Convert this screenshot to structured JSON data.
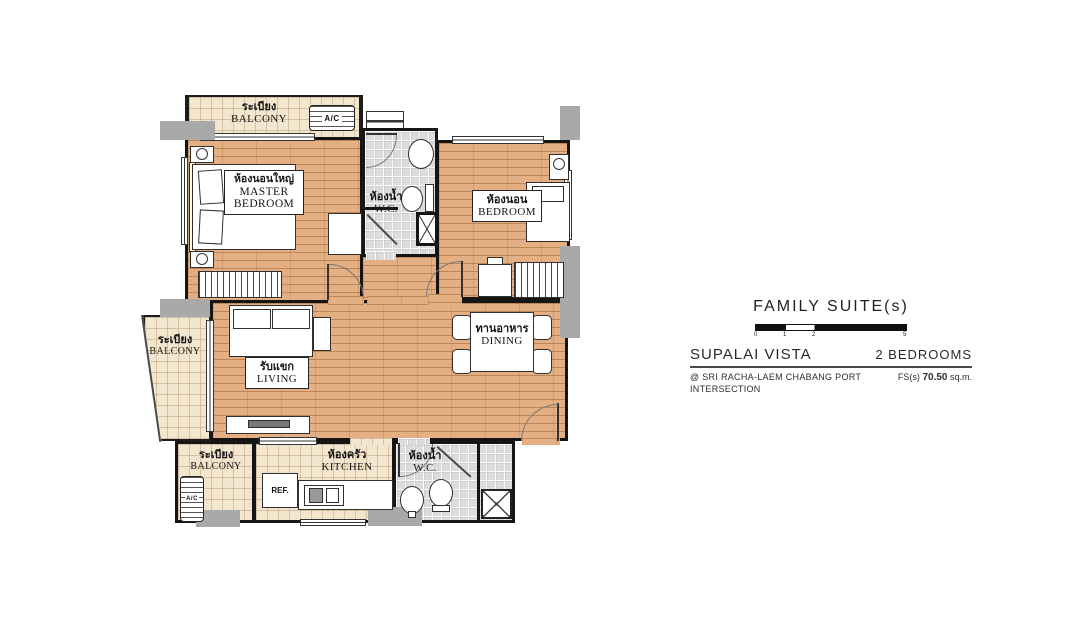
{
  "floorplan": {
    "rooms": {
      "balcony_top": {
        "thai": "ระเบียง",
        "en": "BALCONY"
      },
      "balcony_left": {
        "thai": "ระเบียง",
        "en": "BALCONY"
      },
      "balcony_bottom": {
        "thai": "ระเบียง",
        "en": "BALCONY"
      },
      "master_bedroom": {
        "thai": "ห้องนอนใหญ่",
        "en": "MASTER BEDROOM"
      },
      "bedroom": {
        "thai": "ห้องนอน",
        "en": "BEDROOM"
      },
      "wc_top": {
        "thai": "ห้องน้ำ",
        "en": "W.C."
      },
      "wc_bottom": {
        "thai": "ห้องน้ำ",
        "en": "W.C."
      },
      "living": {
        "thai": "รับแขก",
        "en": "LIVING"
      },
      "dining": {
        "thai": "ทานอาหาร",
        "en": "DINING"
      },
      "kitchen": {
        "thai": "ห้องครัว",
        "en": "KITCHEN"
      }
    },
    "equipment": {
      "ac_top": "A/C",
      "ac_bottom": "A/C",
      "fridge": "REF."
    },
    "colors": {
      "wood_floor": "#e4b083",
      "balcony_tile": "#f3e6cf",
      "wc_tile": "#dcdcdc",
      "wall": "#151515",
      "column": "#a9a9a9"
    }
  },
  "info_panel": {
    "type_title": "FAMILY SUITE(s)",
    "scale_ticks": [
      "0",
      "1",
      "2",
      "5"
    ],
    "project_name": "SUPALAI VISTA",
    "bedrooms": "2 BEDROOMS",
    "location_line1": "@ SRI RACHA-LAEM CHABANG PORT",
    "location_line2": "INTERSECTION",
    "area_prefix": "FS(s)",
    "area_value": "70.50",
    "area_unit": "sq.m."
  }
}
